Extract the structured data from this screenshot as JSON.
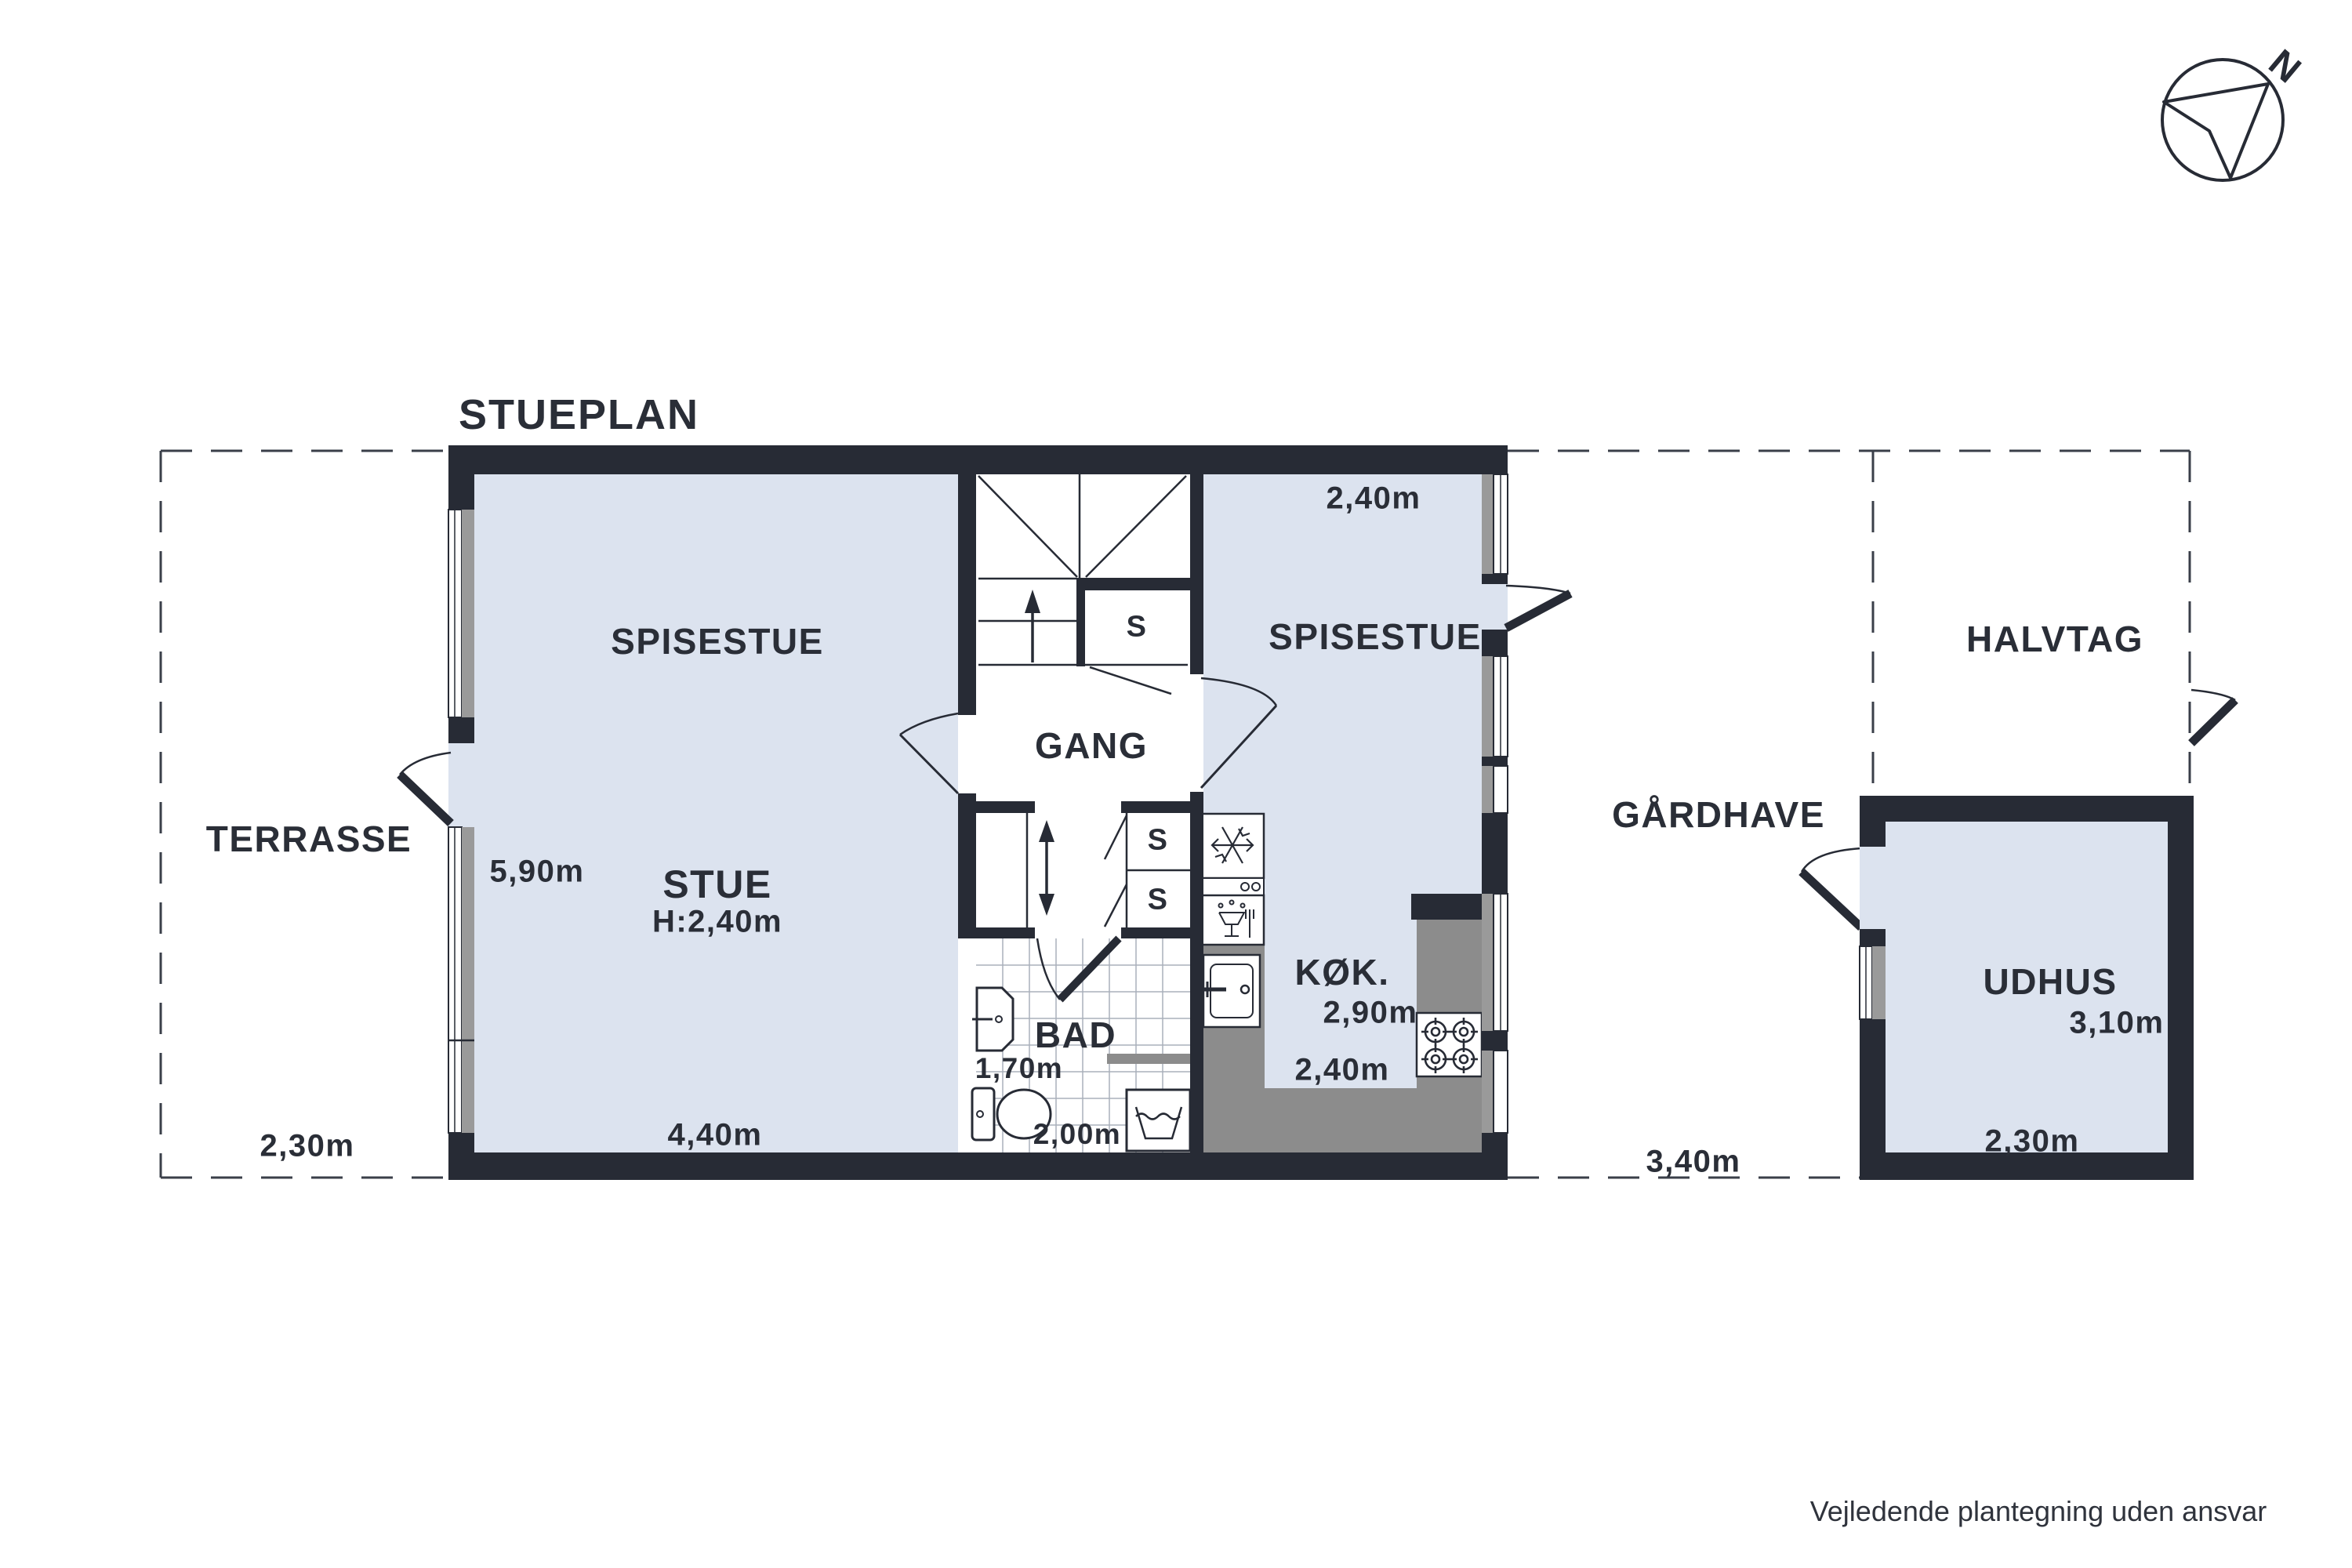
{
  "page": {
    "title": "STUEPLAN",
    "disclaimer": "Vejledende plantegning uden ansvar",
    "compass_label": "N"
  },
  "colors": {
    "wall": "#272b35",
    "floor": "#dce3ef",
    "counter": "#8c8c8c",
    "sill": "#9a9a9a",
    "text": "#2a2e37"
  },
  "icons": [
    "north-compass-icon",
    "freezer-snowflake-icon",
    "oven-icon",
    "dishwasher-icon",
    "kitchen-sink-icon",
    "stove-burners-icon",
    "bath-sink-icon",
    "toilet-icon",
    "washing-machine-icon",
    "stair-arrow-icon",
    "double-arrow-icon"
  ],
  "rooms": {
    "spisestue_left": {
      "label": "SPISESTUE"
    },
    "stue": {
      "label": "STUE",
      "ceiling_height": "H:2,40m",
      "depth": "5,90m",
      "width": "4,40m"
    },
    "gang": {
      "label": "GANG"
    },
    "stair_closet": {
      "label": "S"
    },
    "hall_closet_upper": {
      "label": "S"
    },
    "hall_closet_lower": {
      "label": "S"
    },
    "bad": {
      "label": "BAD",
      "width": "1,70m",
      "length": "2,00m"
    },
    "kok": {
      "label": "KØK.",
      "depth": "2,90m",
      "width": "2,40m"
    },
    "spisestue_right": {
      "label": "SPISESTUE",
      "width": "2,40m"
    },
    "terrasse": {
      "label": "TERRASSE",
      "width": "2,30m"
    },
    "gaardhave": {
      "label": "GÅRDHAVE",
      "width": "3,40m"
    },
    "halvtag": {
      "label": "HALVTAG"
    },
    "udhus": {
      "label": "UDHUS",
      "depth": "3,10m",
      "width": "2,30m"
    }
  }
}
